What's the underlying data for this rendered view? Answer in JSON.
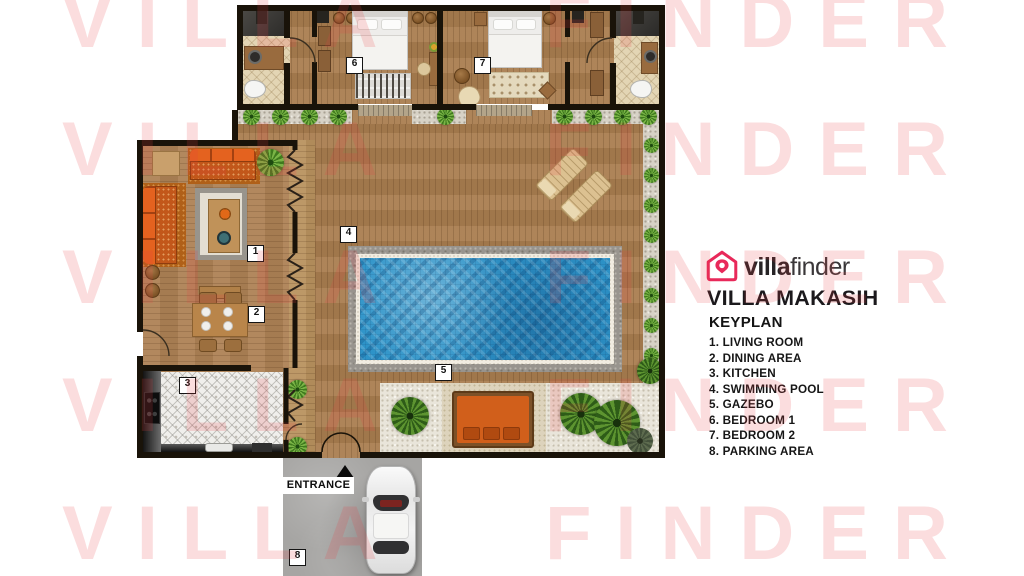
{
  "watermark": {
    "word_left": "VILLA",
    "word_right": "FINDER",
    "color": "#fad9da"
  },
  "brand": {
    "name_bold": "villa",
    "name_light": "finder",
    "icon": "house-pin-icon",
    "pink": "#e8295a"
  },
  "villa_title": "VILLA MAKASIH",
  "keyplan": {
    "heading": "KEYPLAN",
    "items": [
      "1. LIVING ROOM",
      "2. DINING AREA",
      "3. KITCHEN",
      "4. SWIMMING POOL",
      "5. GAZEBO",
      "6. BEDROOM 1",
      "7. BEDROOM 2",
      "8. PARKING AREA"
    ]
  },
  "plan": {
    "entrance_label": "ENTRANCE",
    "labels": {
      "living": "1",
      "dining": "2",
      "kitchen": "3",
      "pool": "4",
      "gazebo": "5",
      "bedroom1": "6",
      "bedroom2": "7",
      "parking": "8"
    }
  },
  "colors": {
    "wall_black": "#191309",
    "deck_wood": "#aa7e50",
    "pool_water": "#2d93c8",
    "sofa_orange": "#e4621f",
    "gravel": "#d7d2c6",
    "concrete": "#a6a5a3",
    "text_dark": "#1b191c"
  }
}
